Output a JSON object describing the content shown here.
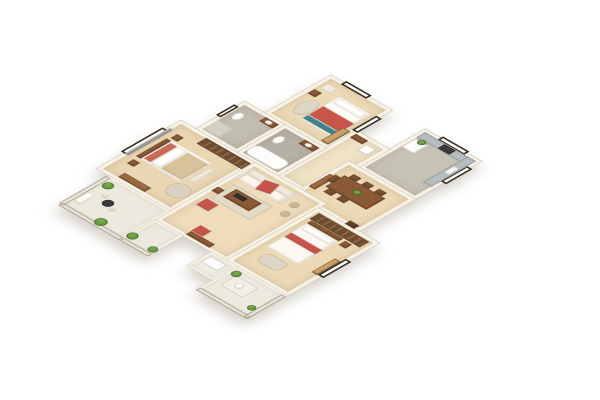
{
  "meta": {
    "description": "3D isometric render of a 3-bedroom apartment floor plan on a white background",
    "view": "isometric cutaway top-down",
    "background_color": "#ffffff"
  },
  "palette": {
    "wood_floor": "#ecd9b6",
    "wood_floor_light": "#f0e2c4",
    "tile_gray": "#bdb7ab",
    "wall_cream": "#f8f3e8",
    "accent_red": "#c6544a",
    "accent_teal": "#3f8391",
    "furniture_brown": "#8a5a37",
    "wardrobe_brown": "#6f4c30",
    "plant_green": "#5f9641",
    "window_frame": "#342818"
  },
  "scene": {
    "plan_w": 420,
    "plan_h": 500,
    "rooms": [
      {
        "id": "bedroom-2",
        "x": 70,
        "y": 0,
        "w": 120,
        "h": 130,
        "bg": "#ecd9b6"
      },
      {
        "id": "kitchen",
        "x": 255,
        "y": 0,
        "w": 110,
        "h": 130,
        "bg": "#c7c2b6"
      },
      {
        "id": "hallway",
        "x": 190,
        "y": 70,
        "w": 65,
        "h": 155,
        "bg": "#f0e2c4"
      },
      {
        "id": "bathroom-1",
        "x": 30,
        "y": 130,
        "w": 80,
        "h": 95,
        "bg": "#c2bdb1"
      },
      {
        "id": "bathroom-2",
        "x": 110,
        "y": 130,
        "w": 80,
        "h": 95,
        "bg": "#b5b0a5"
      },
      {
        "id": "dining-room",
        "x": 235,
        "y": 130,
        "w": 130,
        "h": 110,
        "bg": "#ecd9b6"
      },
      {
        "id": "master-bedroom",
        "x": 0,
        "y": 225,
        "w": 145,
        "h": 165,
        "bg": "#ead6b2"
      },
      {
        "id": "living-room",
        "x": 145,
        "y": 225,
        "w": 140,
        "h": 195,
        "bg": "#eedcba"
      },
      {
        "id": "bedroom-3",
        "x": 285,
        "y": 240,
        "w": 120,
        "h": 180,
        "bg": "#ecd9b6"
      },
      {
        "id": "balcony-master",
        "x": 25,
        "y": 390,
        "w": 120,
        "h": 100,
        "bg": "#eceadf",
        "cls": "balc"
      },
      {
        "id": "balcony-living",
        "x": 145,
        "y": 420,
        "w": 55,
        "h": 70,
        "bg": "#eceadf",
        "cls": "balc"
      },
      {
        "id": "ac-ledge",
        "x": 255,
        "y": 420,
        "w": 50,
        "h": 48,
        "bg": "#efede4",
        "cls": "balc"
      },
      {
        "id": "balcony-bedroom-3",
        "x": 305,
        "y": 420,
        "w": 100,
        "h": 80,
        "bg": "#eceadf",
        "cls": "balc"
      }
    ],
    "items": [
      {
        "id": "window-bedroom2-top",
        "cls": "win",
        "x": 95,
        "y": -5,
        "w": 50,
        "h": 11
      },
      {
        "id": "window-bedroom2-side",
        "cls": "win",
        "x": 184,
        "y": 25,
        "w": 11,
        "h": 48
      },
      {
        "id": "window-kitchen-top",
        "cls": "win",
        "x": 285,
        "y": -5,
        "w": 52,
        "h": 11
      },
      {
        "id": "window-kitchen-side",
        "cls": "win",
        "x": 359,
        "y": 22,
        "w": 11,
        "h": 52
      },
      {
        "id": "window-master-side",
        "cls": "win",
        "x": -6,
        "y": 255,
        "w": 11,
        "h": 82
      },
      {
        "id": "window-bedroom3-side",
        "cls": "win",
        "x": 399,
        "y": 300,
        "w": 11,
        "h": 55
      },
      {
        "id": "window-bathroom1-side",
        "cls": "win",
        "x": 25,
        "y": 145,
        "w": 9,
        "h": 36
      },
      {
        "id": "rug-bedroom2",
        "cls": "rug round",
        "x": 88,
        "y": 58,
        "w": 26,
        "h": 44,
        "bg": "#ddd5c5"
      },
      {
        "id": "bed-bedroom2",
        "cls": "soft",
        "x": 115,
        "y": 28,
        "w": 62,
        "h": 78,
        "bg": "#fdfbf4"
      },
      {
        "id": "pillows-bedroom2",
        "cls": "soft",
        "x": 119,
        "y": 32,
        "w": 54,
        "h": 14,
        "bg": "#ffffff"
      },
      {
        "id": "blanket-bedroom2",
        "cls": "soft",
        "x": 115,
        "y": 60,
        "w": 62,
        "h": 30,
        "bg": "#c7554a"
      },
      {
        "id": "footthrow-bedroom2",
        "cls": "soft",
        "x": 115,
        "y": 90,
        "w": 62,
        "h": 12,
        "bg": "#3f8391"
      },
      {
        "id": "armchair-bedroom2",
        "cls": "soft",
        "x": 82,
        "y": 18,
        "w": 20,
        "h": 16,
        "bg": "#f1ecdf"
      },
      {
        "id": "nightstand-bedroom2",
        "cls": "woodf",
        "x": 78,
        "y": 40,
        "w": 14,
        "h": 14,
        "bg": "#8a5a38"
      },
      {
        "id": "desk-bedroom2",
        "cls": "woodf",
        "x": 172,
        "y": 78,
        "w": 14,
        "h": 44,
        "bg": "#caa36b"
      },
      {
        "id": "counter-kitchen-top",
        "cls": "counter",
        "x": 260,
        "y": 5,
        "w": 100,
        "h": 17
      },
      {
        "id": "counter-kitchen-side",
        "cls": "counter",
        "x": 343,
        "y": 5,
        "w": 17,
        "h": 88
      },
      {
        "id": "stove-kitchen",
        "cls": "dark",
        "x": 300,
        "y": 7,
        "w": 22,
        "h": 13,
        "bg": "#3a3a3a"
      },
      {
        "id": "sink-kitchen",
        "cls": "fixture",
        "x": 347,
        "y": 35,
        "w": 10,
        "h": 20
      },
      {
        "id": "fridge-kitchen",
        "cls": "fixture",
        "x": 262,
        "y": 26,
        "w": 24,
        "h": 28
      },
      {
        "id": "plant-kitchen",
        "cls": "plant round",
        "x": 268,
        "y": 20,
        "w": 13,
        "h": 13
      },
      {
        "id": "washer-hallway",
        "cls": "fixture",
        "x": 224,
        "y": 84,
        "w": 19,
        "h": 19
      },
      {
        "id": "cabinet-hallway",
        "cls": "woodf",
        "x": 195,
        "y": 76,
        "w": 24,
        "h": 12,
        "bg": "#8a5a38"
      },
      {
        "id": "shoe-cabinet-hallway",
        "cls": "woodf",
        "x": 238,
        "y": 170,
        "w": 12,
        "h": 42,
        "bg": "#9a6a44"
      },
      {
        "id": "toilet-bathroom1",
        "cls": "fixture round",
        "x": 42,
        "y": 152,
        "w": 15,
        "h": 21
      },
      {
        "id": "vanity-bathroom1",
        "cls": "woodf",
        "x": 78,
        "y": 136,
        "w": 26,
        "h": 13,
        "bg": "#8a5a38"
      },
      {
        "id": "basin-bathroom1",
        "cls": "fixture round",
        "x": 84,
        "y": 138,
        "w": 12,
        "h": 9
      },
      {
        "id": "shower-bathroom1",
        "cls": "fixture",
        "x": 36,
        "y": 188,
        "w": 32,
        "h": 30,
        "bg": "#d4cfc5"
      },
      {
        "id": "toilet-bathroom2",
        "cls": "fixture round",
        "x": 122,
        "y": 152,
        "w": 15,
        "h": 21
      },
      {
        "id": "vanity-bathroom2",
        "cls": "woodf",
        "x": 155,
        "y": 136,
        "w": 28,
        "h": 13,
        "bg": "#8a5a38"
      },
      {
        "id": "basin-bathroom2",
        "cls": "fixture round",
        "x": 162,
        "y": 138,
        "w": 12,
        "h": 9
      },
      {
        "id": "bathtub-bathroom2",
        "cls": "fixture",
        "x": 116,
        "y": 190,
        "w": 66,
        "h": 28,
        "br": 10
      },
      {
        "id": "dining-table",
        "cls": "woodf",
        "x": 255,
        "y": 158,
        "w": 80,
        "h": 38,
        "bg": "#8a5a37"
      },
      {
        "id": "chair-dining-1",
        "cls": "woodf",
        "x": 262,
        "y": 147,
        "w": 15,
        "h": 11,
        "bg": "#7a5233"
      },
      {
        "id": "chair-dining-2",
        "cls": "woodf",
        "x": 287,
        "y": 147,
        "w": 15,
        "h": 11,
        "bg": "#7a5233"
      },
      {
        "id": "chair-dining-3",
        "cls": "woodf",
        "x": 312,
        "y": 147,
        "w": 15,
        "h": 11,
        "bg": "#7a5233"
      },
      {
        "id": "chair-dining-4",
        "cls": "woodf",
        "x": 262,
        "y": 196,
        "w": 15,
        "h": 11,
        "bg": "#7a5233"
      },
      {
        "id": "chair-dining-5",
        "cls": "woodf",
        "x": 287,
        "y": 196,
        "w": 15,
        "h": 11,
        "bg": "#7a5233"
      },
      {
        "id": "chair-dining-6",
        "cls": "woodf",
        "x": 245,
        "y": 166,
        "w": 11,
        "h": 18,
        "bg": "#7a5233"
      },
      {
        "id": "centerpiece-dining",
        "cls": "plant round",
        "x": 290,
        "y": 170,
        "w": 13,
        "h": 11
      },
      {
        "id": "entry-door",
        "cls": "woodf",
        "x": 338,
        "y": 230,
        "w": 18,
        "h": 11,
        "bg": "#5d3d26"
      },
      {
        "id": "wardrobe-master",
        "cls": "wardrobe",
        "x": 55,
        "y": 230,
        "w": 88,
        "h": 19
      },
      {
        "id": "accent-wall-master",
        "cls": "soft",
        "x": 2,
        "y": 248,
        "w": 8,
        "h": 90,
        "bg": "#9b9b98"
      },
      {
        "id": "bed-master",
        "cls": "soft",
        "x": 25,
        "y": 268,
        "w": 80,
        "h": 64,
        "bg": "#fbf8f1"
      },
      {
        "id": "headboard-master",
        "cls": "woodf",
        "x": 17,
        "y": 270,
        "w": 9,
        "h": 60,
        "bg": "#8a5a38"
      },
      {
        "id": "pillows-master",
        "cls": "soft",
        "x": 28,
        "y": 273,
        "w": 14,
        "h": 54,
        "bg": "#cc6a58"
      },
      {
        "id": "sheet-master",
        "cls": "soft",
        "x": 43,
        "y": 273,
        "w": 18,
        "h": 54,
        "bg": "#ffffff"
      },
      {
        "id": "blanket-master",
        "cls": "soft",
        "x": 62,
        "y": 273,
        "w": 41,
        "h": 54,
        "bg": "#d8c29a"
      },
      {
        "id": "bench-master",
        "cls": "soft",
        "x": 110,
        "y": 278,
        "w": 11,
        "h": 44,
        "bg": "#efe9dc"
      },
      {
        "id": "nightstand-master-1",
        "cls": "woodf",
        "x": 20,
        "y": 252,
        "w": 13,
        "h": 13,
        "bg": "#8a5a38"
      },
      {
        "id": "nightstand-master-2",
        "cls": "woodf",
        "x": 20,
        "y": 338,
        "w": 13,
        "h": 13,
        "bg": "#8a5a38"
      },
      {
        "id": "rug-master",
        "cls": "rug round",
        "x": 100,
        "y": 330,
        "w": 36,
        "h": 36,
        "bg": "#d9d2c2"
      },
      {
        "id": "dresser-master",
        "cls": "woodf",
        "x": 35,
        "y": 370,
        "w": 52,
        "h": 13,
        "bg": "#9a6a44"
      },
      {
        "id": "rug-living",
        "cls": "rug",
        "x": 162,
        "y": 282,
        "w": 76,
        "h": 46,
        "bg": "#e3dac6"
      },
      {
        "id": "sofa-back",
        "cls": "soft",
        "x": 155,
        "y": 238,
        "w": 82,
        "h": 14,
        "bg": "#f1ebdd"
      },
      {
        "id": "sofa-seat",
        "cls": "soft",
        "x": 155,
        "y": 252,
        "w": 82,
        "h": 18,
        "bg": "#faf6ec"
      },
      {
        "id": "sofa-arm-left",
        "cls": "soft",
        "x": 150,
        "y": 238,
        "w": 8,
        "h": 34,
        "bg": "#ece5d4"
      },
      {
        "id": "sofa-arm-right",
        "cls": "soft",
        "x": 234,
        "y": 238,
        "w": 8,
        "h": 34,
        "bg": "#ece5d4"
      },
      {
        "id": "throw-sofa",
        "cls": "soft",
        "x": 186,
        "y": 240,
        "w": 26,
        "h": 28,
        "bg": "#c6544a",
        "rot": -14
      },
      {
        "id": "coffee-table",
        "cls": "woodf",
        "x": 172,
        "y": 288,
        "w": 50,
        "h": 26,
        "bg": "#8a5a37"
      },
      {
        "id": "tray-coffee-table",
        "cls": "dark",
        "x": 180,
        "y": 294,
        "w": 20,
        "h": 9,
        "bg": "#2f2f2f"
      },
      {
        "id": "ottoman-1",
        "cls": "soft round",
        "x": 248,
        "y": 250,
        "w": 17,
        "h": 17,
        "bg": "#cdb693"
      },
      {
        "id": "ottoman-2",
        "cls": "soft round",
        "x": 254,
        "y": 274,
        "w": 17,
        "h": 17,
        "bg": "#cdb693"
      },
      {
        "id": "armchair-living",
        "cls": "soft",
        "x": 158,
        "y": 332,
        "w": 25,
        "h": 23,
        "bg": "#c6544a"
      },
      {
        "id": "side-table-living",
        "cls": "woodf",
        "x": 150,
        "y": 302,
        "w": 13,
        "h": 13,
        "bg": "#8a5a38"
      },
      {
        "id": "tv-console-living",
        "cls": "woodf",
        "x": 200,
        "y": 404,
        "w": 46,
        "h": 11,
        "bg": "#8a5a37"
      },
      {
        "id": "accent-chair-red",
        "cls": "soft",
        "x": 198,
        "y": 384,
        "w": 23,
        "h": 20,
        "bg": "#c6544a"
      },
      {
        "id": "wardrobe-bedroom3",
        "cls": "wardrobe",
        "x": 295,
        "y": 248,
        "w": 98,
        "h": 19
      },
      {
        "id": "headboard-bedroom3",
        "cls": "woodf",
        "x": 300,
        "y": 268,
        "w": 62,
        "h": 9,
        "bg": "#8a5a38"
      },
      {
        "id": "bed-bedroom3",
        "cls": "soft",
        "x": 300,
        "y": 277,
        "w": 62,
        "h": 80,
        "bg": "#fbf8f1"
      },
      {
        "id": "pillows-bedroom3",
        "cls": "soft",
        "x": 304,
        "y": 280,
        "w": 54,
        "h": 13,
        "bg": "#ffffff"
      },
      {
        "id": "runner-bedroom3",
        "cls": "soft",
        "x": 300,
        "y": 308,
        "w": 62,
        "h": 15,
        "bg": "#c6544a"
      },
      {
        "id": "nightstand-bedroom3",
        "cls": "woodf",
        "x": 368,
        "y": 270,
        "w": 13,
        "h": 13,
        "bg": "#8a5a38"
      },
      {
        "id": "rug-bedroom3",
        "cls": "rug",
        "x": 312,
        "y": 365,
        "w": 42,
        "h": 26,
        "bg": "#ddd5c5",
        "br": 10
      },
      {
        "id": "desk-bedroom3",
        "cls": "woodf",
        "x": 388,
        "y": 310,
        "w": 11,
        "h": 46,
        "bg": "#caa36b"
      },
      {
        "id": "rail-balcony-master-side",
        "cls": "glass",
        "x": 22,
        "y": 394,
        "w": 8,
        "h": 92
      },
      {
        "id": "rail-balcony-master-bottom",
        "cls": "glass",
        "x": 26,
        "y": 482,
        "w": 118,
        "h": 8
      },
      {
        "id": "rail-balcony-living-bottom",
        "cls": "glass",
        "x": 146,
        "y": 482,
        "w": 54,
        "h": 8
      },
      {
        "id": "plant-balcony-1",
        "cls": "plant round",
        "x": 32,
        "y": 400,
        "w": 17,
        "h": 17
      },
      {
        "id": "plant-balcony-2",
        "cls": "plant round",
        "x": 86,
        "y": 468,
        "w": 19,
        "h": 19
      },
      {
        "id": "plant-balcony-3",
        "cls": "plant round",
        "x": 142,
        "y": 462,
        "w": 17,
        "h": 17
      },
      {
        "id": "plant-balcony-4",
        "cls": "plant round",
        "x": 186,
        "y": 466,
        "w": 15,
        "h": 15
      },
      {
        "id": "bistro-table-balcony",
        "cls": "dark round",
        "x": 62,
        "y": 430,
        "w": 17,
        "h": 17,
        "bg": "#3a3a3a"
      },
      {
        "id": "bistro-chair-1",
        "cls": "soft round",
        "x": 50,
        "y": 424,
        "w": 11,
        "h": 11,
        "bg": "#e8e2d2"
      },
      {
        "id": "bistro-chair-2",
        "cls": "soft round",
        "x": 80,
        "y": 440,
        "w": 11,
        "h": 11,
        "bg": "#e8e2d2"
      },
      {
        "id": "shelf-balcony",
        "cls": "fixture",
        "x": 32,
        "y": 438,
        "w": 13,
        "h": 30
      },
      {
        "id": "ac-unit",
        "cls": "fixture",
        "x": 262,
        "y": 428,
        "w": 32,
        "h": 20
      },
      {
        "id": "rug-balcony-bedroom3",
        "cls": "rug",
        "x": 320,
        "y": 436,
        "w": 44,
        "h": 32,
        "bg": "#f2efe6",
        "br": 6
      },
      {
        "id": "table-balcony-bedroom3",
        "cls": "fixture round",
        "x": 334,
        "y": 444,
        "w": 14,
        "h": 14
      },
      {
        "id": "plant-balcony-b3-1",
        "cls": "plant round",
        "x": 310,
        "y": 426,
        "w": 15,
        "h": 15
      },
      {
        "id": "plant-balcony-b3-2",
        "cls": "plant round",
        "x": 384,
        "y": 470,
        "w": 13,
        "h": 13
      },
      {
        "id": "rail-balcony-b3-bottom",
        "cls": "glass",
        "x": 306,
        "y": 492,
        "w": 98,
        "h": 8
      },
      {
        "id": "rail-balcony-b3-side",
        "cls": "glass",
        "x": 397,
        "y": 424,
        "w": 8,
        "h": 74
      }
    ]
  }
}
